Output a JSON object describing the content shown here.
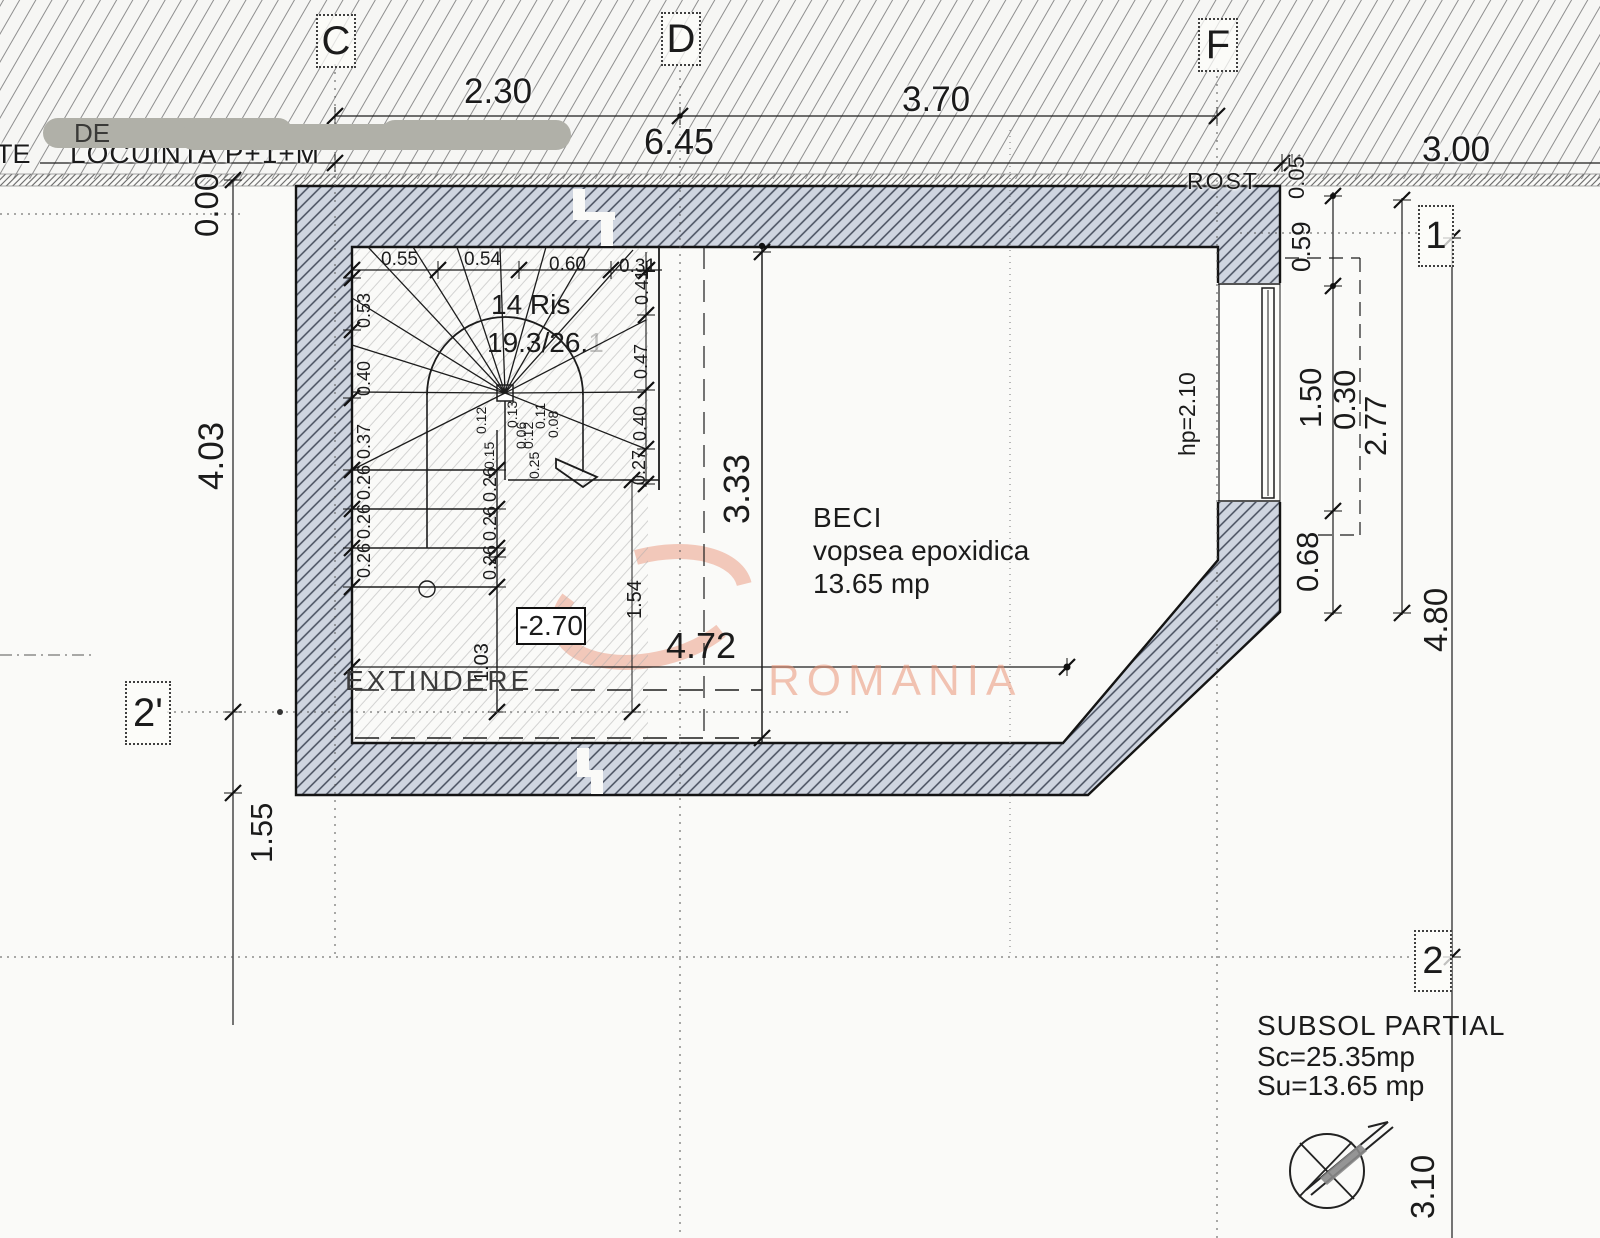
{
  "drawing": {
    "watermark": "ROMANIA",
    "colors": {
      "watermark_pink": "#e9947a",
      "wall_fill": "#cfd5e0"
    },
    "grid_markers": {
      "c": "C",
      "d": "D",
      "f": "F",
      "r1": "1",
      "r2": "2",
      "r2p": "2'"
    },
    "top_dims": {
      "c_d": "2.30",
      "d_f": "3.70",
      "total": "6.45",
      "right": "3.00"
    },
    "left_dims": {
      "level": "0.00",
      "height": "4.03",
      "lower": "1.55"
    },
    "right_dims": {
      "joint": "0.05",
      "parapet": "0.59",
      "window": "1.50",
      "pier": "0.30",
      "total": "2.77",
      "sill": "0.68",
      "span": "4.80",
      "lower": "3.10"
    },
    "labels": {
      "edge_fragment": "TE",
      "covered_fragment": "DE",
      "neighbor": "LOCUINTA P+1+M",
      "joint": "ROST",
      "extension": "EXTINDERE",
      "level_marker": "-2.70",
      "parapet_height": "hp=2.10"
    },
    "room": {
      "name": "BECI",
      "finish": "vopsea epoxidica",
      "area": "13.65 mp",
      "width": "3.33",
      "length": "4.72"
    },
    "stair": {
      "risers": "14 Ris",
      "ratio": "19.3/26.",
      "ratio_faded": "1",
      "top_treads": [
        "0.55",
        "0.54",
        "0.60",
        "0.31"
      ],
      "right_treads": [
        "0.41",
        "0.47",
        "0.40",
        "0.27"
      ],
      "left_risers": [
        "0.53",
        "0.40",
        "0.37",
        "0.26",
        "0.26",
        "0.26"
      ],
      "inner_risers": [
        "0.26",
        "0.26",
        "0.26"
      ],
      "center_dims": [
        "0.12",
        "0.15",
        "0.13",
        "0.06",
        "0.12",
        "0.11",
        "0.08",
        "0.25"
      ],
      "well": "1.54",
      "landing": "1.03"
    },
    "titleblock": {
      "title": "SUBSOL PARTIAL",
      "built_area": "Sc=25.35mp",
      "usable_area": "Su=13.65 mp"
    }
  }
}
